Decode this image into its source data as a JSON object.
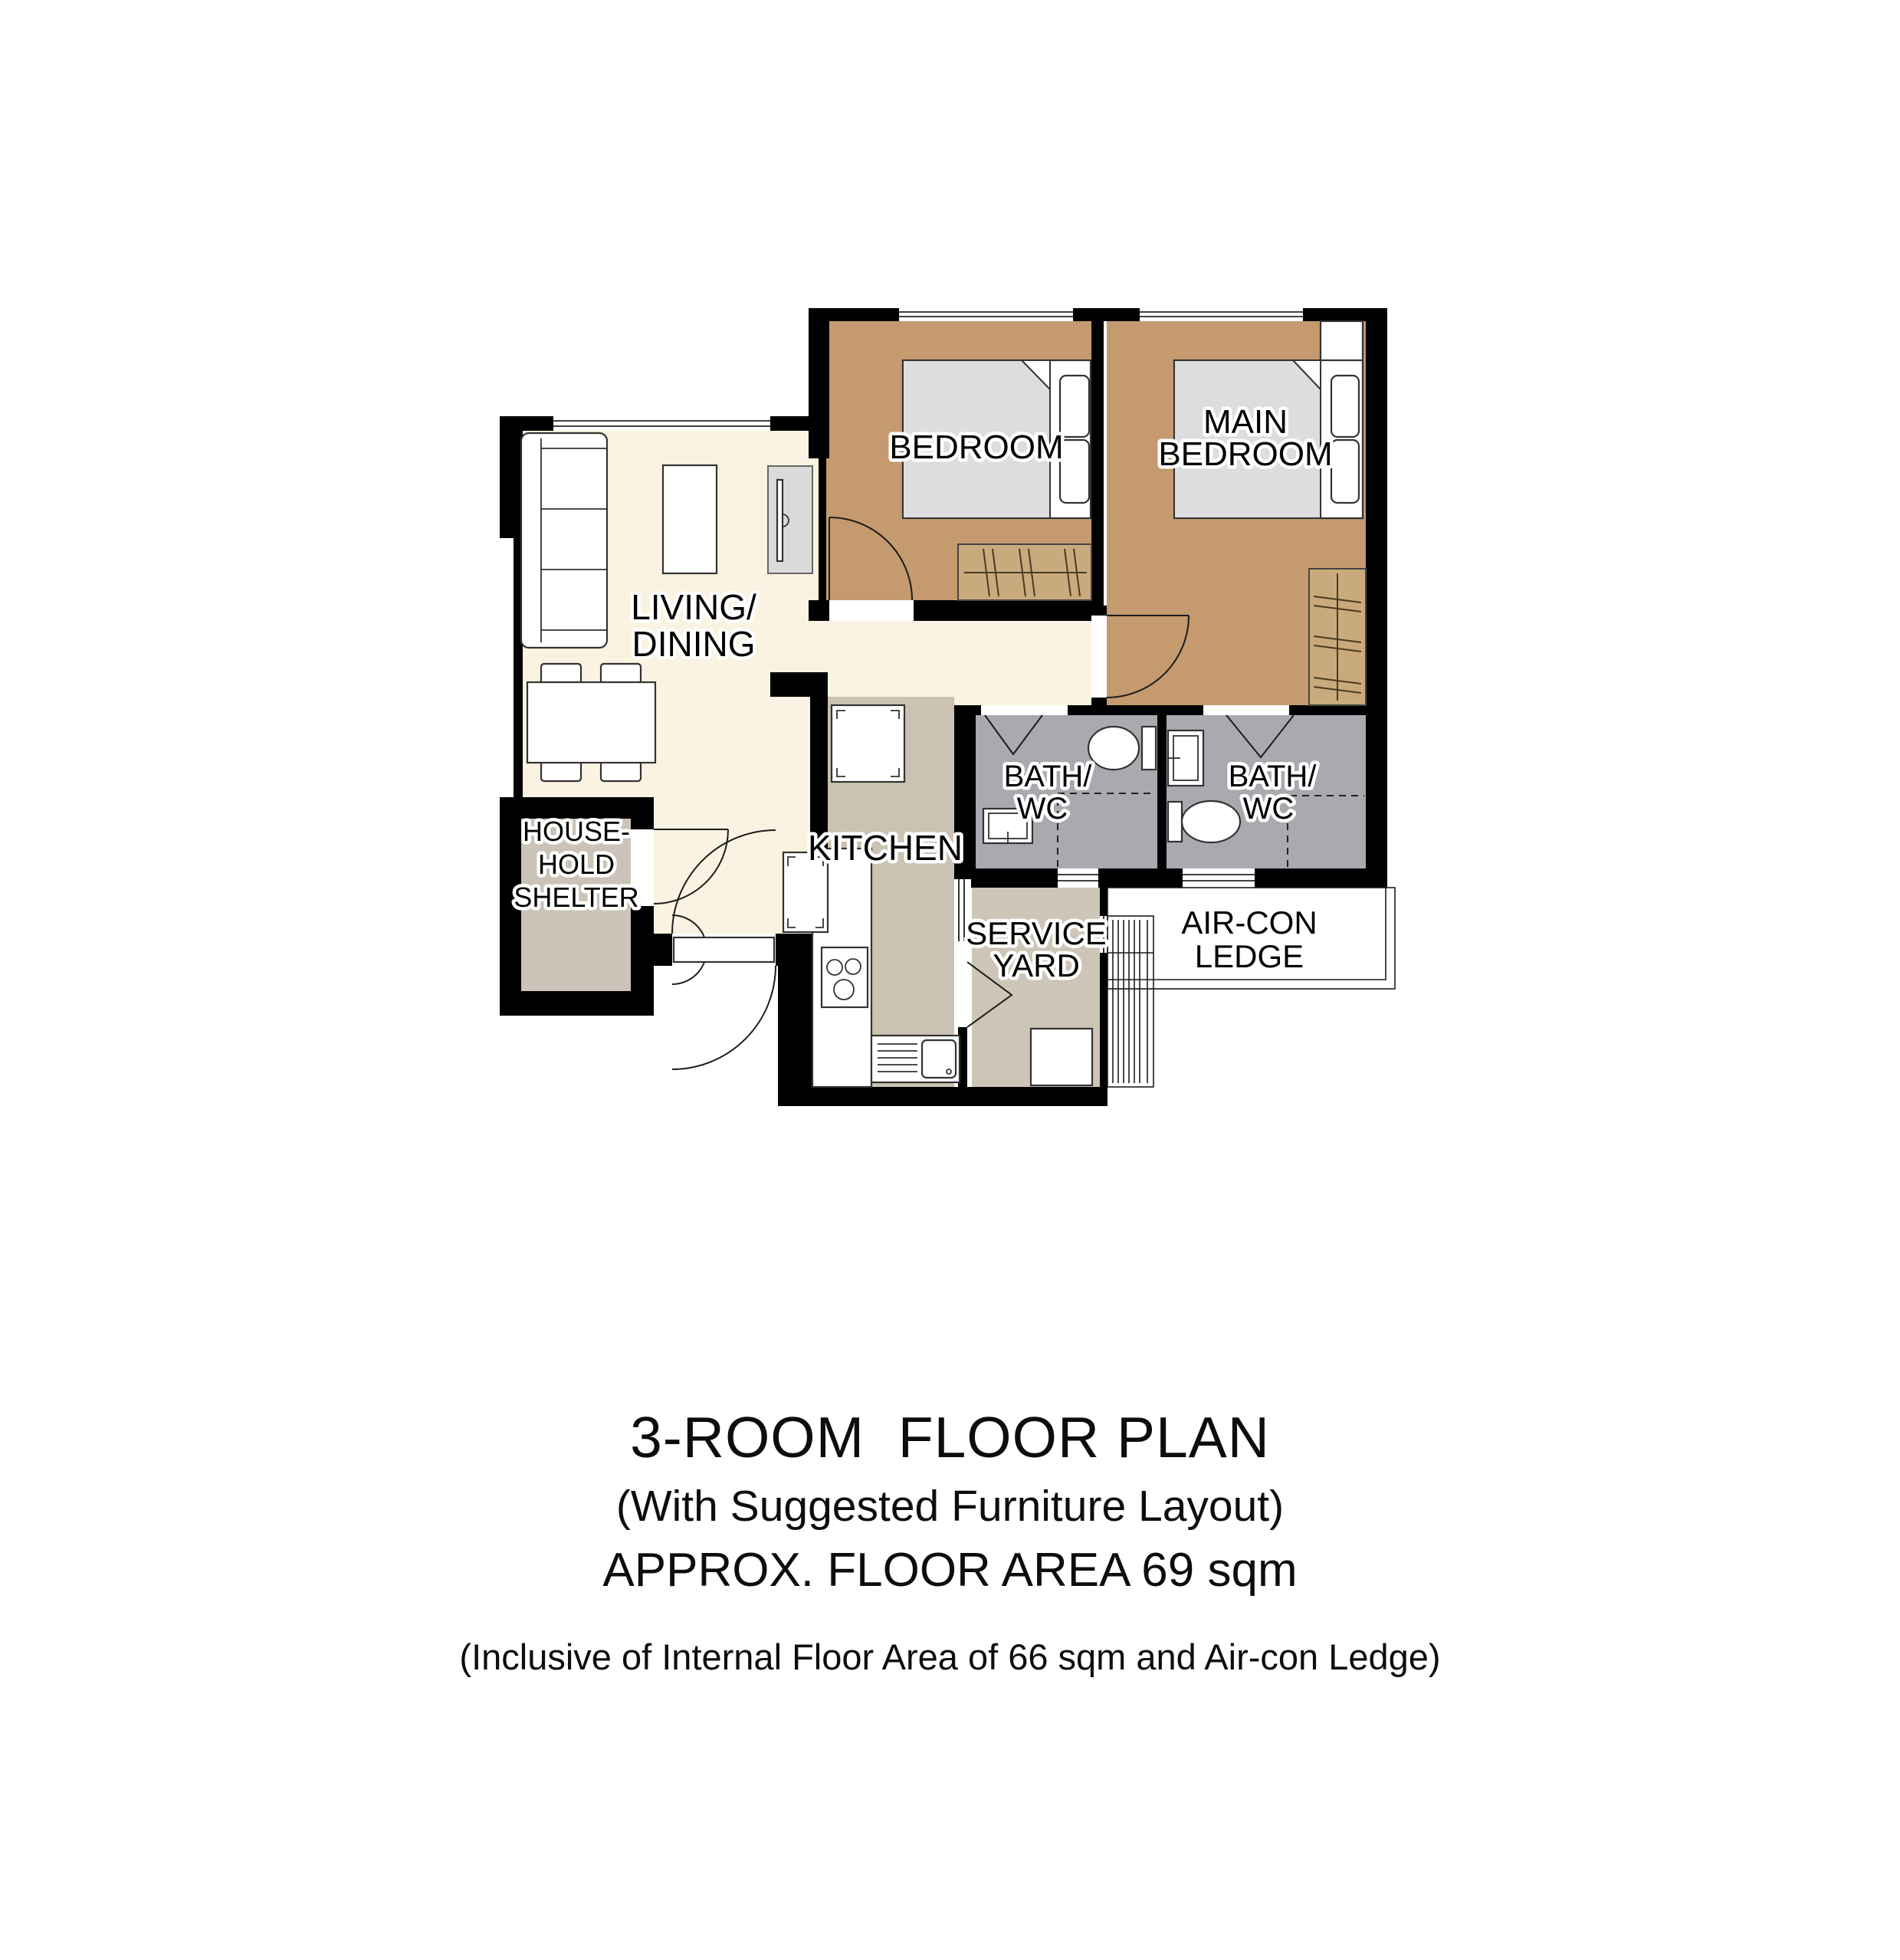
{
  "plan": {
    "rooms": {
      "living": {
        "label_line1": "LIVING/",
        "label_line2": "DINING"
      },
      "bedroom": {
        "label": "BEDROOM"
      },
      "main_bedroom": {
        "label_line1": "MAIN",
        "label_line2": "BEDROOM"
      },
      "kitchen": {
        "label": "KITCHEN"
      },
      "bath1": {
        "label_line1": "BATH/",
        "label_line2": "WC"
      },
      "bath2": {
        "label_line1": "BATH/",
        "label_line2": "WC"
      },
      "service_yard": {
        "label_line1": "SERVICE",
        "label_line2": "YARD"
      },
      "aircon_ledge": {
        "label_line1": "AIR-CON",
        "label_line2": "LEDGE"
      },
      "household_shelter": {
        "label_line1": "HOUSE-",
        "label_line2": "HOLD",
        "label_line3": "SHELTER"
      }
    },
    "colors": {
      "wall": "#000000",
      "living_floor": "#FBF3E1",
      "bedroom_floor": "#C49A6E",
      "bath_floor": "#A9A9B0",
      "kitchen_floor": "#CBC2B2",
      "service_floor": "#CDC5B6",
      "shelter_floor": "#CBC3B7",
      "wardrobe": "#C9AA7D",
      "bed": "#DDDDE0",
      "tv_console": "#DADADA"
    }
  },
  "caption": {
    "title": "3-ROOM  FLOOR PLAN",
    "subtitle": "(With Suggested Furniture Layout)",
    "area": "APPROX. FLOOR AREA 69 sqm",
    "note": "(Inclusive of Internal Floor Area of 66 sqm and Air-con Ledge)"
  }
}
